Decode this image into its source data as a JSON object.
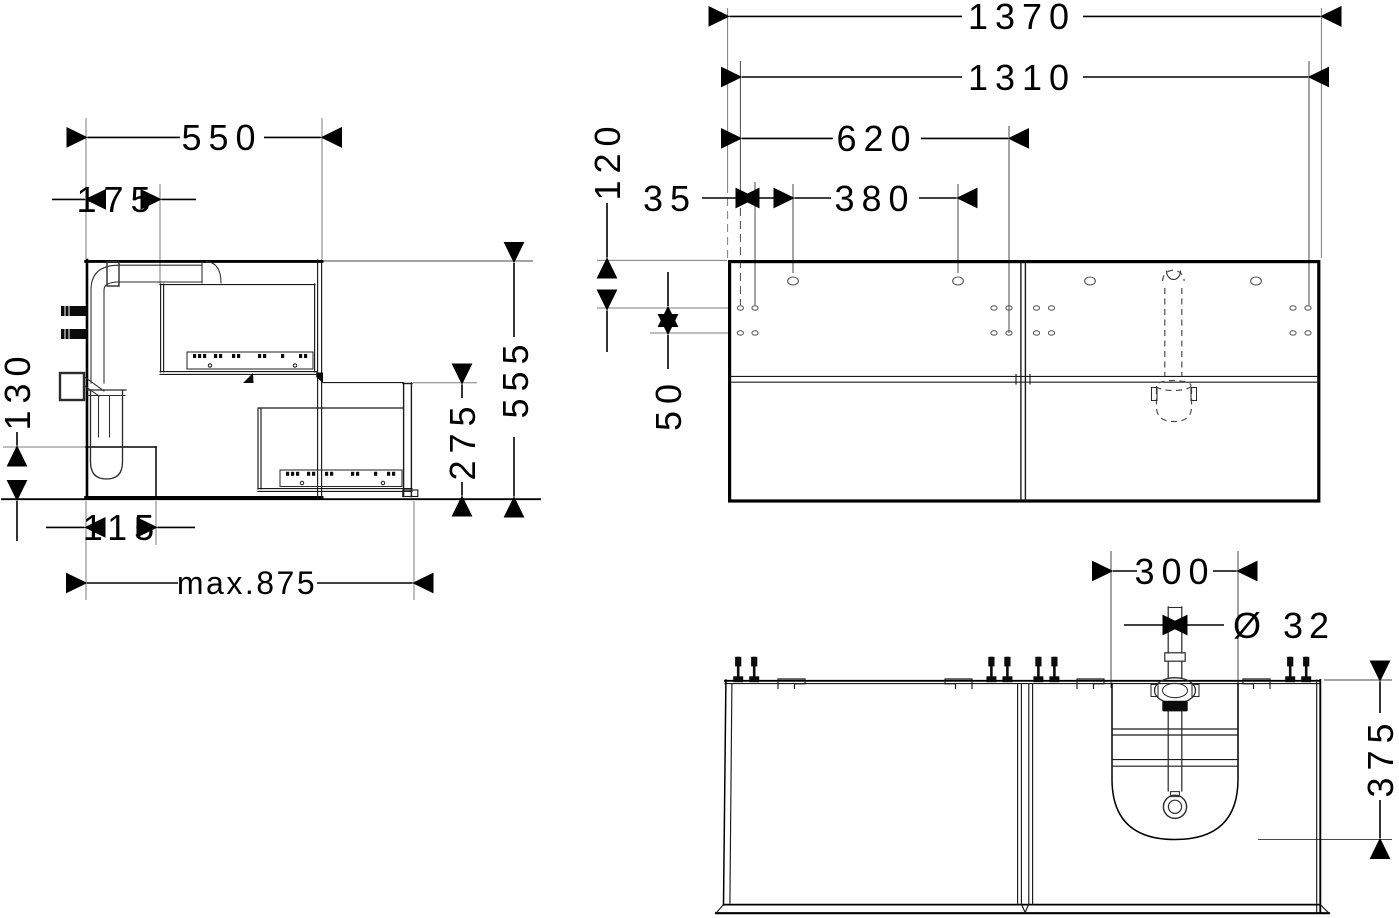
{
  "drawing": {
    "side": {
      "depth": "550",
      "pipe_offset": "175",
      "recess_height": "130",
      "recess_depth": "115",
      "pullout": "max.875",
      "drawer_front_height": "275",
      "height": "555"
    },
    "front": {
      "width_total": "1370",
      "width_inner": "1310",
      "hole_span": "620",
      "top_offset": "120",
      "edge_offset": "35",
      "hole_spacing": "380",
      "row_spacing": "50"
    },
    "plan": {
      "cutout_width": "300",
      "pipe_diameter": "Ø 32",
      "cutout_depth": "375"
    },
    "colors": {
      "line": "#000000",
      "extension": "#7d7d7d",
      "background": "#ffffff"
    }
  }
}
